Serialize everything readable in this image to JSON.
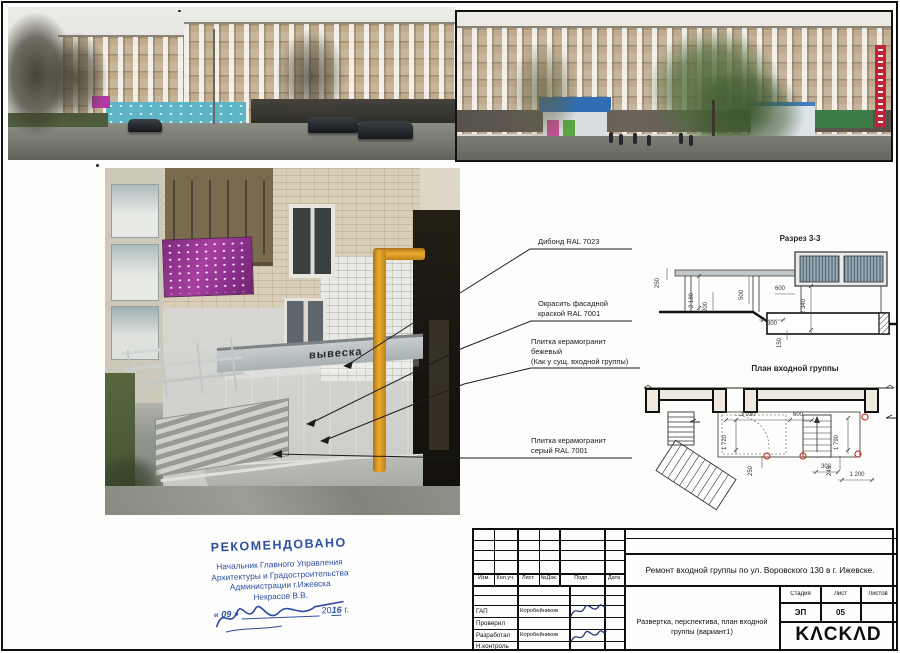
{
  "photo_labels": {
    "vyveska": "вывеска"
  },
  "callouts": [
    {
      "lines": [
        "Дибонд RAL 7023"
      ]
    },
    {
      "lines": [
        "Окрасить фасадной",
        "краской RAL 7001"
      ]
    },
    {
      "lines": [
        "Плитка керамогранит",
        "бежевый",
        "(Как у сущ. входной группы)"
      ]
    },
    {
      "lines": [
        "Плитка керамогранит",
        "серый  RAL 7001"
      ]
    }
  ],
  "section_drawing": {
    "title": "Разрез 3-3",
    "dimensions": [
      "250",
      "2 180",
      "200",
      "500",
      "600",
      "300",
      "2 340",
      "150"
    ]
  },
  "plan_drawing": {
    "title": "План входной группы",
    "dimensions": [
      "3 030",
      "600",
      "1 720",
      "250",
      "300",
      "1 790",
      "245",
      "1 200"
    ]
  },
  "stamp": {
    "heading": "РЕКОМЕНДОВАНО",
    "lines": [
      "Начальник Главного Управления",
      "Архитектуры и Градостроительства",
      "Администрации г.Ижевска",
      "Некрасов В.В."
    ],
    "date": {
      "open": "« 09 »",
      "year_prefix": "20",
      "year_value": "16",
      "suffix": "г."
    }
  },
  "titleblock": {
    "header_cols": [
      "Изм.",
      "Кол.уч.",
      "Лист",
      "№Док.",
      "Подп.",
      "Дата"
    ],
    "project_title": "Ремонт входной группы по ул. Воровского 130 в г. Ижевске.",
    "sheet_title": "Развертка, перспектива, план входной группы (вариант1)",
    "roles": [
      {
        "label": "ГАП",
        "name": "Коробейников"
      },
      {
        "label": "Проверил",
        "name": ""
      },
      {
        "label": "Разработал",
        "name": "Коробейников"
      },
      {
        "label": "Н.контроль",
        "name": ""
      }
    ],
    "stage_label": "Стадия",
    "stage_value": "ЭП",
    "sheet_label": "Лист",
    "sheet_value": "05",
    "sheets_label": "Листов",
    "sheets_value": "",
    "logo": "KΛCKΛD"
  },
  "colors": {
    "stamp_blue": "#2f4fa2",
    "marker_red": "#c3392b",
    "pipe_yellow": "#edab2e",
    "banner_magenta": "#a83fa0",
    "sign_red": "#c22334",
    "kiosk_blue": "#2f6db5",
    "line_black": "#1b1b1b"
  }
}
